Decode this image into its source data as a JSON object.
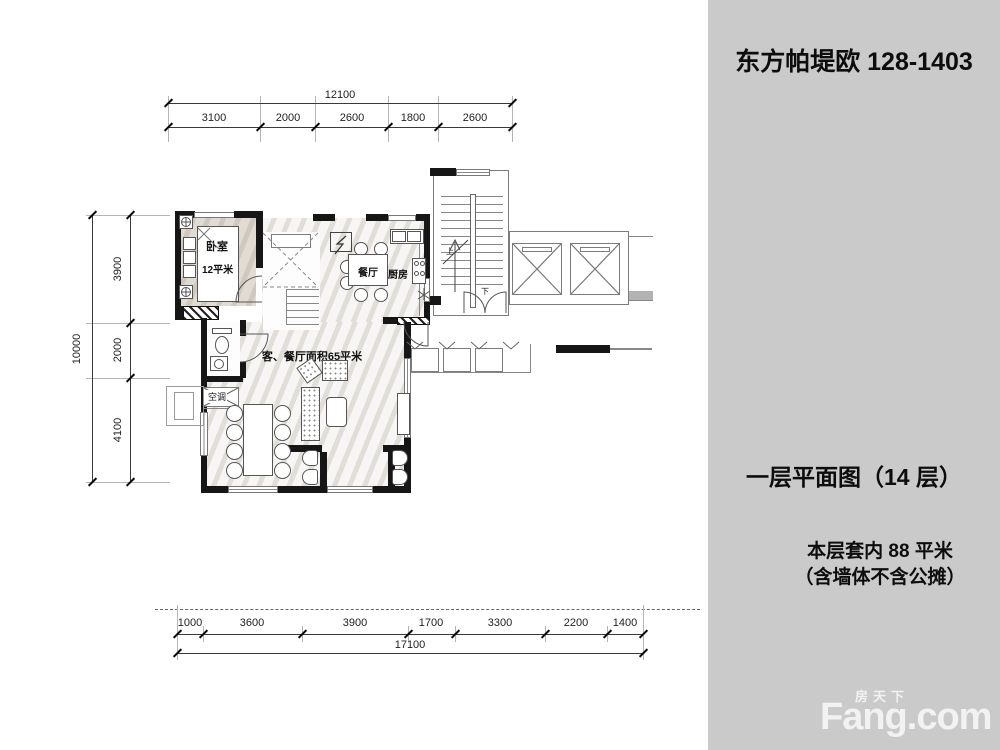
{
  "panel": {
    "title": "东方帕堤欧 128-1403",
    "plan_title": "一层平面图（14 层）",
    "area_line1": "本层套内 88 平米",
    "area_line2": "（含墙体不含公摊）",
    "watermark_cn": "房天下",
    "watermark_en": "Fang.com"
  },
  "rooms": {
    "bedroom": "卧室",
    "bedroom_area": "12平米",
    "dining": "餐厅",
    "kitchen": "厨房",
    "living": "客、餐厅面积65平米",
    "ac": "空调",
    "up": "上",
    "down": "下"
  },
  "dimensions": {
    "top": {
      "total": "12100",
      "segments": [
        "3100",
        "2000",
        "2600",
        "1800",
        "2600"
      ]
    },
    "left": {
      "total": "10000",
      "segments": [
        "3900",
        "2000",
        "4100"
      ]
    },
    "bottom": {
      "total": "17100",
      "segments": [
        "1000",
        "3600",
        "3900",
        "1700",
        "3300",
        "2200",
        "1400"
      ]
    }
  },
  "colors": {
    "panel_bg": "#cacaca",
    "wall": "#161616",
    "bedroom_fill": "#d7d0c4",
    "floor_fill": "#edebe6",
    "dim_text": "#222222"
  }
}
